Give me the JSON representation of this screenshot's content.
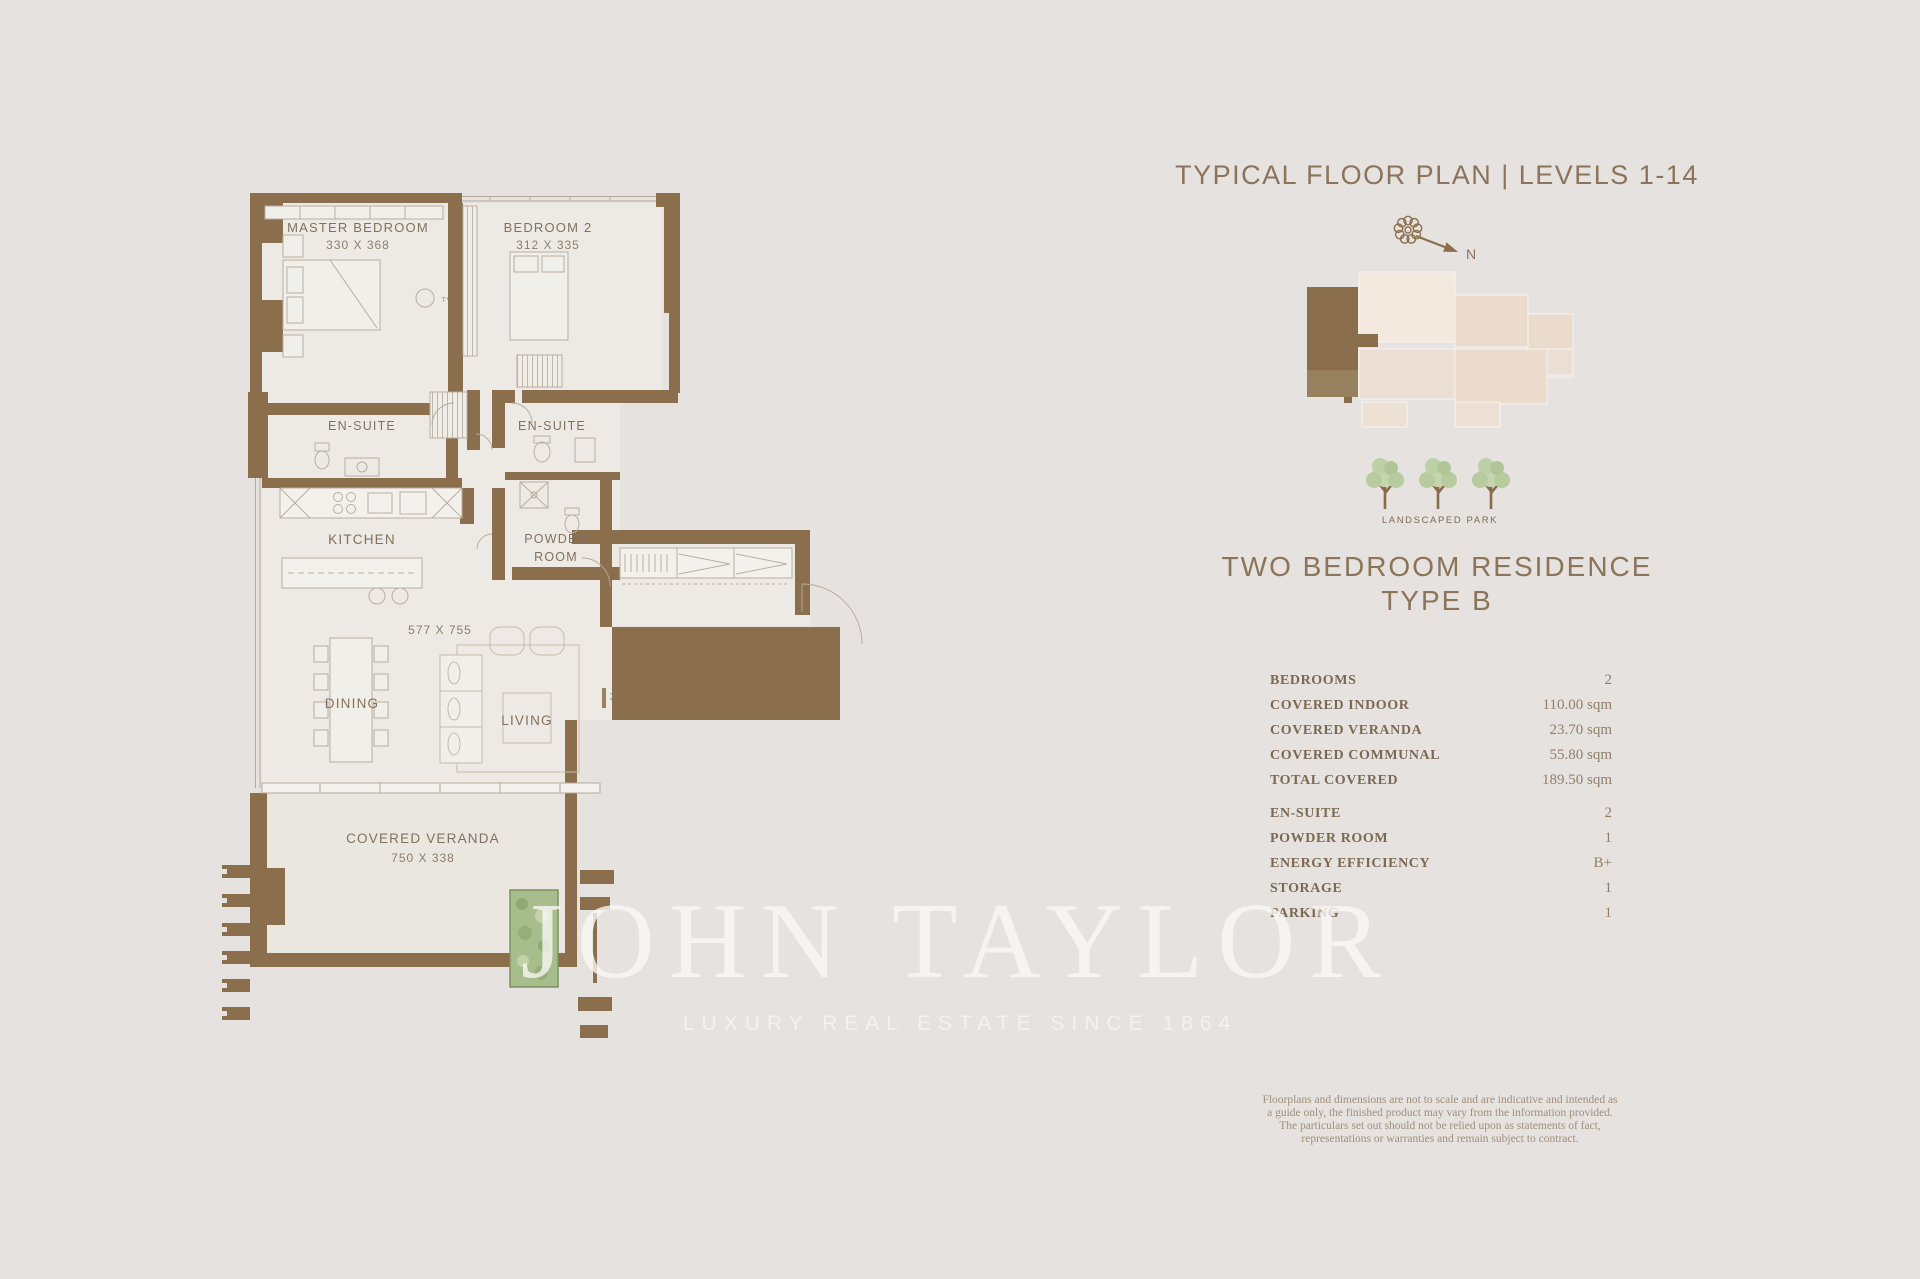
{
  "colors": {
    "background": "#e5e2e0",
    "wall_brown": "#8b6f4d",
    "room_cream": "#edeae5",
    "accent_text": "#8b7459",
    "keyplan_unit": "#8a6e4b",
    "keyplan_plate": "#eadbcc",
    "tree_green": "#bcd0a5",
    "watermark_white": "#faf8f5"
  },
  "floor_plan": {
    "master_bedroom": {
      "label": "MASTER BEDROOM",
      "dims": "330 X 368"
    },
    "bedroom2": {
      "label": "BEDROOM 2",
      "dims": "312 X 335"
    },
    "ensuite_left": {
      "label": "EN-SUITE"
    },
    "ensuite_right": {
      "label": "EN-SUITE"
    },
    "kitchen": {
      "label": "KITCHEN"
    },
    "powder_line1": "POWDER",
    "powder_line2": "ROOM",
    "living_dining_dims": "577 X 755",
    "dining": {
      "label": "DINING"
    },
    "living": {
      "label": "LIVING"
    },
    "veranda": {
      "label": "COVERED VERANDA",
      "dims": "750 X 338"
    },
    "tv": "TV"
  },
  "sidebar": {
    "title": "TYPICAL FLOOR PLAN | LEVELS 1-14",
    "compass_n": "N",
    "park_label": "LANDSCAPED PARK",
    "residence_line1": "TWO BEDROOM RESIDENCE",
    "residence_line2": "TYPE B",
    "specs": [
      {
        "label": "BEDROOMS",
        "value": "2"
      },
      {
        "label": "COVERED INDOOR",
        "value": "110.00 sqm"
      },
      {
        "label": "COVERED VERANDA",
        "value": "23.70 sqm"
      },
      {
        "label": "COVERED COMMUNAL",
        "value": "55.80 sqm"
      },
      {
        "label": "TOTAL COVERED",
        "value": "189.50 sqm"
      },
      {
        "label": "EN-SUITE",
        "value": "2"
      },
      {
        "label": "POWDER ROOM",
        "value": "1"
      },
      {
        "label": "ENERGY EFFICIENCY",
        "value": "B+"
      },
      {
        "label": "STORAGE",
        "value": "1"
      },
      {
        "label": "PARKING",
        "value": "1"
      }
    ],
    "disclaimer": "Floorplans and dimensions are not to scale and are indicative and intended as a guide only, the finished product may vary from the information provided. The particulars set out should not be relied upon as statements of fact, representations or warranties and remain subject to contract."
  },
  "watermark": {
    "brand": "JOHN TAYLOR",
    "tagline": "LUXURY REAL ESTATE SINCE 1864"
  }
}
